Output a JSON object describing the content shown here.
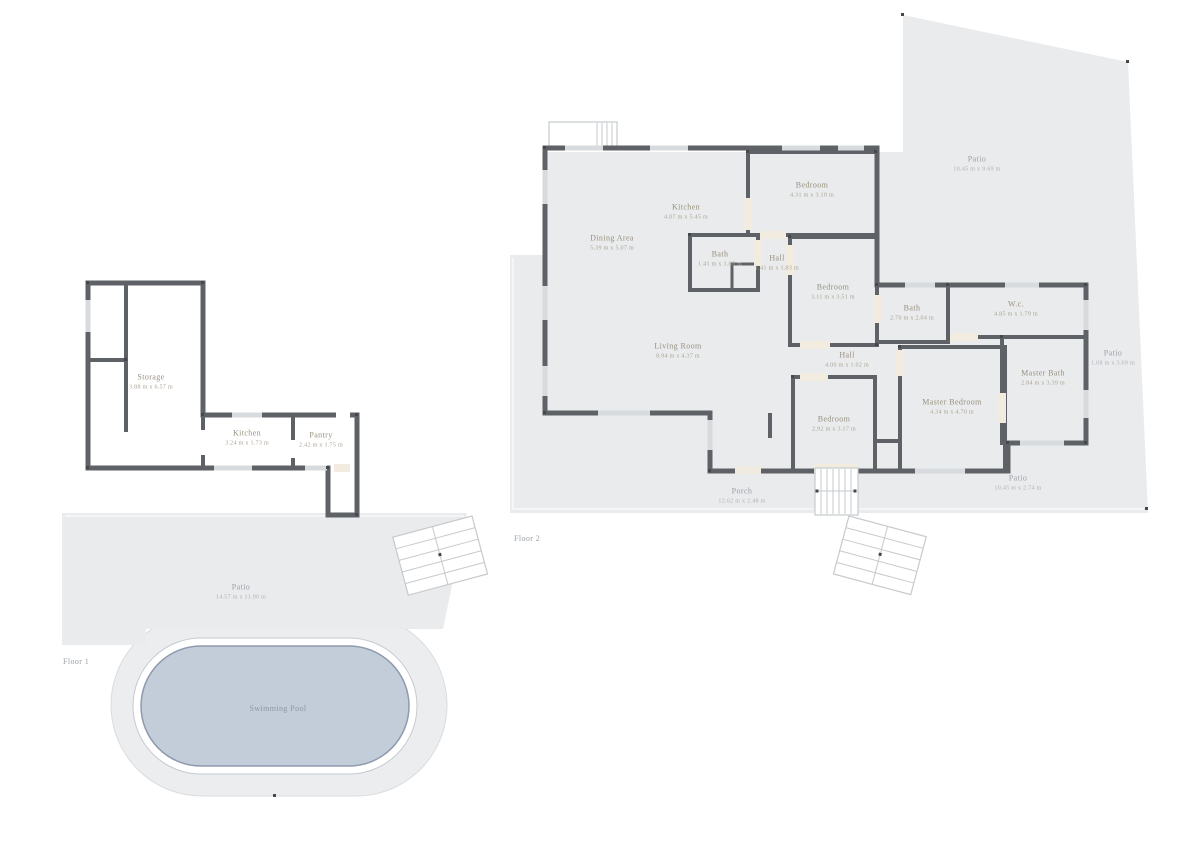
{
  "document": {
    "type": "floor-plan",
    "floor_count": 2
  },
  "colors": {
    "room_cream": "#f3ede2",
    "room_orange": "#efa06c",
    "room_teal": "#a8cbd3",
    "patio_gray": "#e9ebed",
    "patio_blob": "#ecedef",
    "pool_water": "#c3cdd9",
    "pool_edge": "#8e9aad",
    "wall": "#5e6266"
  },
  "floors": {
    "floor1": {
      "label": "Floor 1",
      "rooms": {
        "storage": {
          "name": "Storage",
          "dims": "3.88 m x 6.57 m"
        },
        "kitchen": {
          "name": "Kitchen",
          "dims": "3.24 m x 1.73 m"
        },
        "pantry": {
          "name": "Pantry",
          "dims": "2.42 m x 1.75 m"
        }
      },
      "outdoor": {
        "patio": {
          "name": "Patio",
          "dims": "14.57 m x 11.90 m"
        },
        "swimming_pool": {
          "name": "Swimming Pool"
        }
      }
    },
    "floor2": {
      "label": "Floor 2",
      "rooms": {
        "dining_area": {
          "name": "Dining Area",
          "dims": "5.39 m x 5.07 m"
        },
        "kitchen": {
          "name": "Kitchen",
          "dims": "4.07 m x 5.45 m"
        },
        "living_room": {
          "name": "Living Room",
          "dims": "8.94 m x 4.37 m"
        },
        "bedroom_1": {
          "name": "Bedroom",
          "dims": "4.31 m x 3.10 m"
        },
        "bath_1": {
          "name": "Bath",
          "dims": "1.41 m x 1.85 m"
        },
        "hall_1": {
          "name": "Hall",
          "dims": "1.41 m x 1.83 m"
        },
        "bedroom_2": {
          "name": "Bedroom",
          "dims": "3.11 m x 3.51 m"
        },
        "bath_2": {
          "name": "Bath",
          "dims": "2.70 m x 2.04 m"
        },
        "wc": {
          "name": "W.c.",
          "dims": "4.85 m x 1.79 m"
        },
        "master_bath": {
          "name": "Master Bath",
          "dims": "2.84 m x 3.39 m"
        },
        "hall_2": {
          "name": "Hall",
          "dims": "4.00 m x 1.02 m"
        },
        "bedroom_3": {
          "name": "Bedroom",
          "dims": "2.92 m x 3.17 m"
        },
        "master_bedroom": {
          "name": "Master Bedroom",
          "dims": "4.34 m x 4.70 m"
        }
      },
      "outdoor": {
        "porch": {
          "name": "Porch",
          "dims": "12.62 m x 2.48 m"
        },
        "patio_top": {
          "name": "Patio",
          "dims": "10.45 m x 9.69 m"
        },
        "patio_right": {
          "name": "Patio",
          "dims": "1.08 m x 3.69 m"
        },
        "patio_bottom": {
          "name": "Patio",
          "dims": "10.45 m x 2.74 m"
        }
      }
    }
  }
}
